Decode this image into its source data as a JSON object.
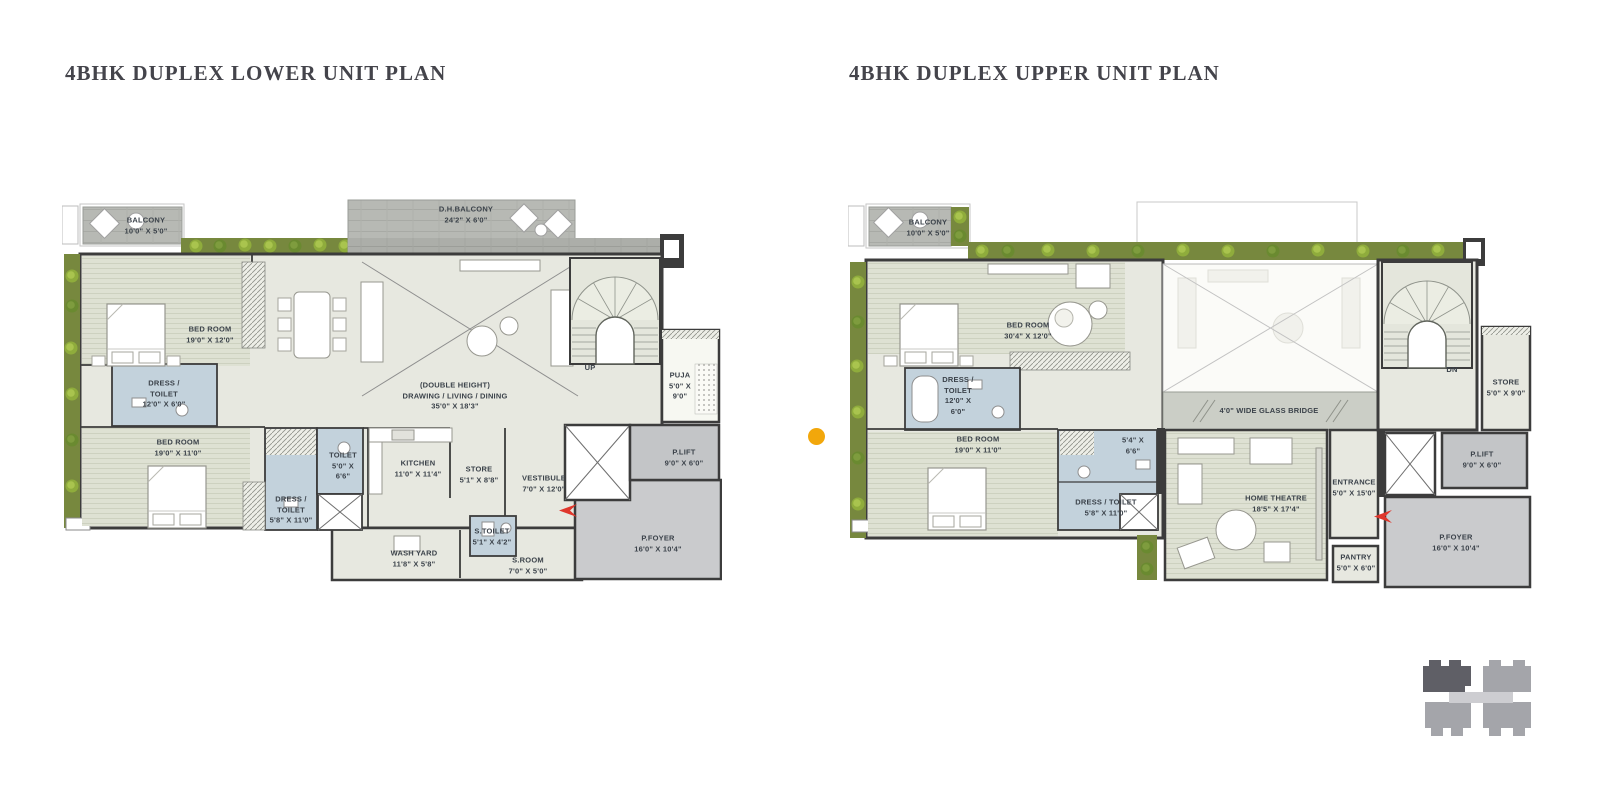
{
  "colors": {
    "wall": "#3C3C3C",
    "floor": "#E7E8E0",
    "floor_stripe": "#DEE1D3",
    "wet_area_blue": "#C3D2DC",
    "deck_gray": "#B7B9B4",
    "planter_green": "#77883E",
    "bush_green": "#8FAC3C",
    "lift_gray": "#C3C5C7",
    "foyer_gray": "#CACBCD",
    "entry_arrow_red": "#DF372C",
    "legend_dot_orange": "#F2A70B",
    "keyplan_dark": "#5F5F66",
    "keyplan_light": "#A4A5AA",
    "title_text": "#44444B",
    "label_text": "#3B424A"
  },
  "plans": [
    {
      "title": "4BHK DUPLEX LOWER UNIT PLAN",
      "stair_label": "UP",
      "rooms": [
        {
          "name": "BALCONY",
          "dims": "10'0\" X 5'0\""
        },
        {
          "name": "D.H.BALCONY",
          "dims": "24'2\" X 6'0\""
        },
        {
          "name": "BED ROOM",
          "dims": "19'0\" X 12'0\""
        },
        {
          "name": "DRESS /",
          "name2": "TOILET",
          "dims": "12'0\" X 6'0\""
        },
        {
          "name": "BED ROOM",
          "dims": "19'0\" X 11'0\""
        },
        {
          "name": "TOILET",
          "name2": "5'0\" X",
          "dims": "6'6\""
        },
        {
          "name": "DRESS /",
          "name2": "TOILET",
          "dims": "5'8\" X 11'0\""
        },
        {
          "name": "(DOUBLE HEIGHT)",
          "name2": "DRAWING / LIVING /  DINING",
          "dims": "35'0\" X 18'3\""
        },
        {
          "name": "KITCHEN",
          "dims": "11'0\" X 11'4\""
        },
        {
          "name": "STORE",
          "dims": "5'1\" X 8'8\""
        },
        {
          "name": "VESTIBULE",
          "dims": "7'0\" X 12'0\""
        },
        {
          "name": "S.TOILET",
          "dims": "5'1\" X 4'2\""
        },
        {
          "name": "WASH YARD",
          "dims": "11'8\" X 5'8\""
        },
        {
          "name": "S.ROOM",
          "dims": "7'0\" X 5'0\""
        },
        {
          "name": "PUJA",
          "name2": "5'0\" X",
          "dims": "9'0\""
        },
        {
          "name": "P.LIFT",
          "dims": "9'0\" X 6'0\""
        },
        {
          "name": "P.FOYER",
          "dims": "16'0\" X 10'4\""
        }
      ]
    },
    {
      "title": "4BHK DUPLEX UPPER UNIT PLAN",
      "stair_label": "DN",
      "rooms": [
        {
          "name": "BALCONY",
          "dims": "10'0\" X 5'0\""
        },
        {
          "name": "BED ROOM",
          "dims": "30'4\" X 12'0\""
        },
        {
          "name": "DRESS /",
          "name2": "TOILET",
          "dims": "12'0\" X",
          "dims2": "6'0\""
        },
        {
          "name": "BED ROOM",
          "dims": "19'0\" X 11'0\""
        },
        {
          "name": "5'4\" X",
          "dims": "6'6\""
        },
        {
          "name": "DRESS / TOILET",
          "dims": "5'8\" X 11'0\""
        },
        {
          "name": "4'0\" WIDE GLASS BRIDGE"
        },
        {
          "name": "HOME THEATRE",
          "dims": "18'5\" X 17'4\""
        },
        {
          "name": "ENTRANCE",
          "dims": "5'0\" X 15'0\""
        },
        {
          "name": "PANTRY",
          "dims": "5'0\" X 6'0\""
        },
        {
          "name": "STORE",
          "dims": "5'0\" X 9'0\""
        },
        {
          "name": "P.LIFT",
          "dims": "9'0\" X 6'0\""
        },
        {
          "name": "P.FOYER",
          "dims": "16'0\" X 10'4\""
        }
      ]
    }
  ]
}
